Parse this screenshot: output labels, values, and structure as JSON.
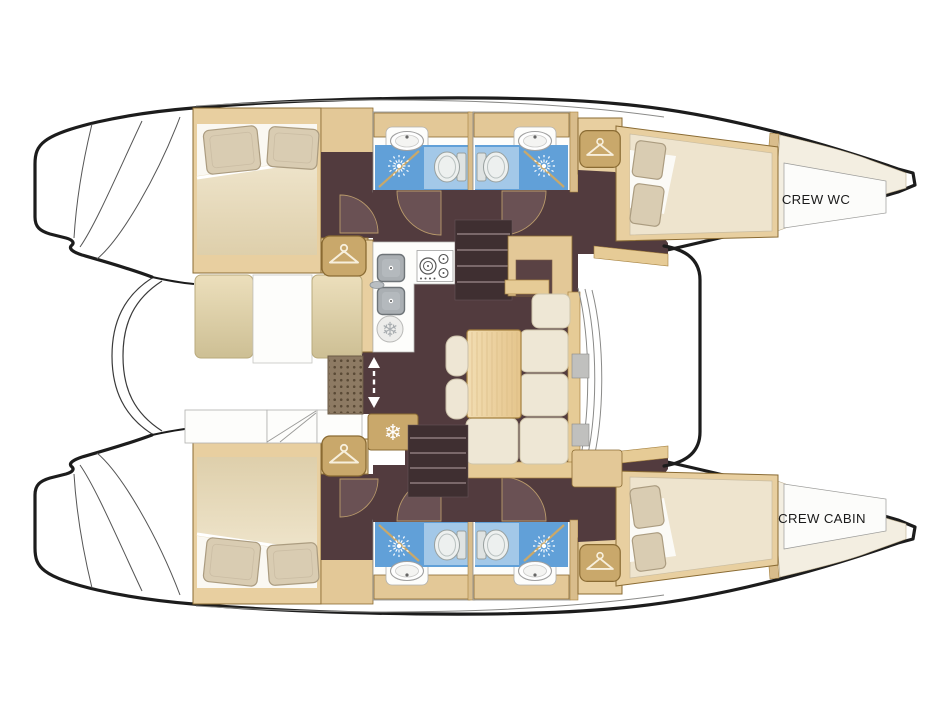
{
  "labels": {
    "crew_wc": "CREW WC",
    "crew_cabin": "CREW CABIN"
  },
  "glyphs": {
    "snowflake": "❄"
  },
  "colors": {
    "hull_outline": "#1c1c1c",
    "wood_light": "#e8cfa0",
    "wood_mid": "#e3c897",
    "wood_dark": "#c9a86b",
    "wood_edge": "#8a6b33",
    "floor_dark": "#523b3e",
    "floor_door": "#6a5154",
    "shower_blue": "#61a0d8",
    "shower_blue_light": "#a3c8e8",
    "cushion_cream": "#eee7d5",
    "cockpit_cushion": "#e2d4a9",
    "bed_blanket": "#e7dcc0",
    "pillow": "#d9ccb2",
    "table_wood": "#ecd4a4",
    "grating": "#8d7a63",
    "fixture_white": "#fdfdfb",
    "label_text": "#1a1a1a"
  },
  "icons": [
    "hanger-icon",
    "snowflake-icon",
    "shower-spray-icon",
    "toilet-icon",
    "sink-icon",
    "stove-icon",
    "galley-sink-icon",
    "door-swing-arc",
    "companionway-arrows-icon"
  ]
}
